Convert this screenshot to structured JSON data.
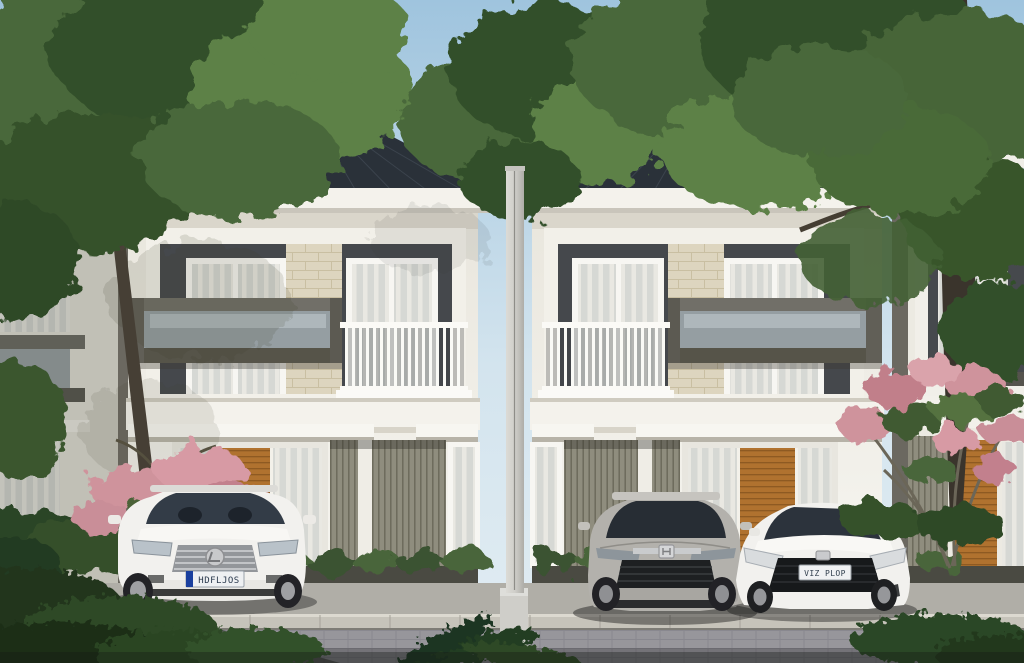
{
  "scene": {
    "title": "Modern two-story townhouses exterior rendering",
    "sky": "clear light blue daytime sky",
    "houses": {
      "style": "modern minimalist two-story townhouse, two identical mirrored units",
      "roof": "dark charcoal hip roof with seamed metal ridges",
      "facade": "white walls, dark gray upper panels, cream stone accent column, olive vertical slat siding, teak wood slat door",
      "balcony": "white vertical-slat railing balcony",
      "window_box": "cantilevered gray box frame window",
      "partial_units": "additional identical units visible at far left and far right edges"
    },
    "vegetation": [
      "large leafy trees flanking and between the houses",
      "pink frangipani blossom shrubs",
      "dark green foreground ferns",
      "low hedge and planter shrubs"
    ],
    "street": "gray paver road with light stone curb and concrete driveway",
    "pole": "white concrete utility pole centered between the two houses",
    "cars": [
      {
        "label": "white-lexus-suv",
        "plate": "HDFLJOS"
      },
      {
        "label": "silver-honda-hrv",
        "plate": ""
      },
      {
        "label": "white-honda-crz",
        "plate": "VIZ PLOP"
      }
    ]
  },
  "colors": {
    "sky_top": "#9fc4de",
    "sky_low": "#d3e4ee",
    "roof": "#2a3139",
    "wall": "#f2f0ea",
    "wall_shade": "#ddd9cf",
    "panel": "#45484c",
    "stone": "#ddd5bf",
    "wood": "#b0722f",
    "slat": "#8f8d7e",
    "foliage_dark": "#33502b",
    "foliage_mid": "#49683a",
    "foliage_light": "#5d8147",
    "trunk": "#3f3931",
    "street": "#97969b",
    "curb": "#c6c3ba",
    "driveway": "#b0aea7",
    "car_white": "#f2f1ee",
    "car_silver": "#b3b1ac",
    "glass_dark": "#2c333c",
    "flower_pink": "#cf939c",
    "plate_blue": "#1a3f9e"
  }
}
